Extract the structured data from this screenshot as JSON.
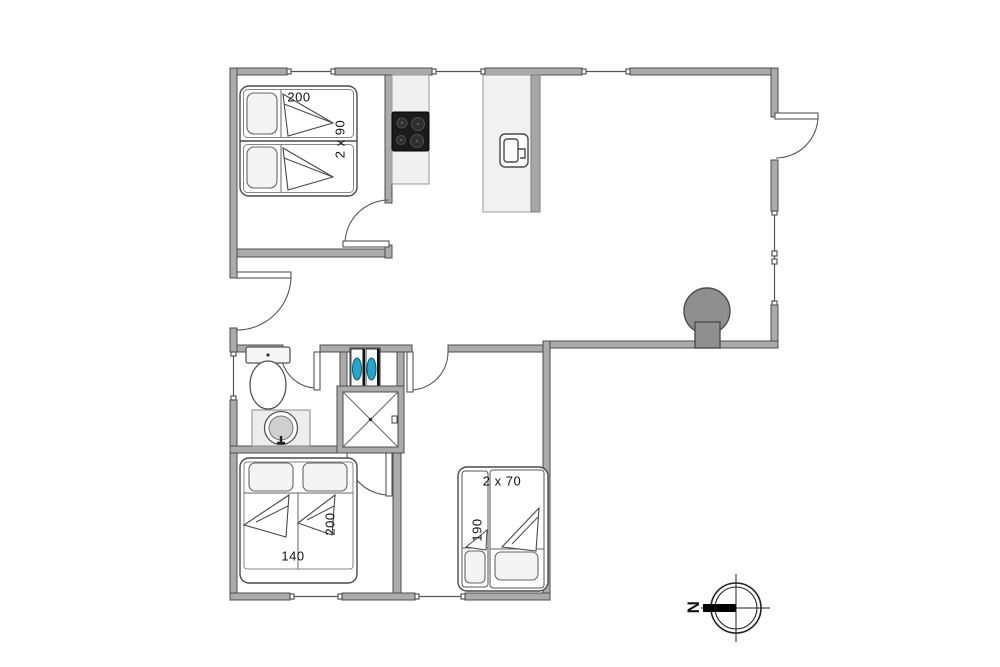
{
  "floorplan": {
    "background": "#ffffff",
    "colors": {
      "wall_fill": "#ababab",
      "wall_stroke": "#4e4e4e",
      "furniture_stroke": "#4a4a4a",
      "counter_fill": "#f0f0f0",
      "stove_fill": "#1b1b1b",
      "fireplace_fill": "#8f8f8f",
      "washer_accent": "#27a5c9",
      "text": "#111111"
    },
    "rooms": {
      "bedroom_top_left": {
        "labels": {
          "length": "200",
          "width": "2 x 90"
        }
      },
      "bedroom_bottom_left": {
        "labels": {
          "width": "140",
          "length": "200"
        }
      },
      "bedroom_bottom_right": {
        "labels": {
          "width": "2 x 70",
          "length": "190"
        }
      }
    },
    "compass": {
      "north": "N"
    },
    "fixtures": [
      "stove-icon",
      "kitchen-island-sink-icon",
      "fireplace-icon",
      "toilet-icon",
      "washbasin-icon",
      "shower-icon",
      "washer-dryer-icon",
      "bed-icon",
      "compass-icon",
      "window-icon",
      "door-icon"
    ]
  }
}
